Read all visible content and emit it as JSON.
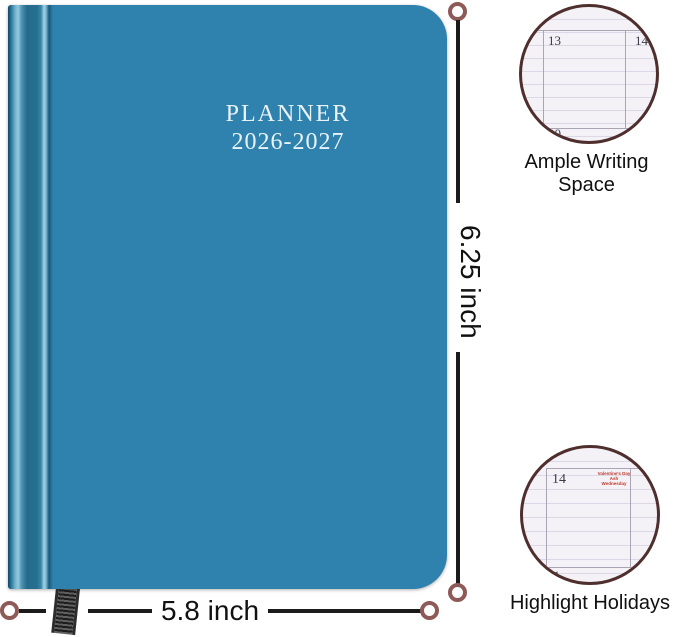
{
  "planner": {
    "title_line1": "PLANNER",
    "title_line2": "2026-2027",
    "cover_color": "#2e82ad"
  },
  "dimensions": {
    "height_label": "6.25 inch",
    "width_label": "5.8 inch"
  },
  "callouts": {
    "writing_space": {
      "label": "Ample Writing Space",
      "day_top_left": "13",
      "day_top_right": "14",
      "day_bottom_left": "20"
    },
    "holidays": {
      "label": "Highlight Holidays",
      "day_top_left": "14",
      "day_bottom_left": "21",
      "holiday_line1": "Valentine's Day",
      "holiday_line2": "Ash Wednesday"
    }
  },
  "colors": {
    "cover": "#2e82ad",
    "spine_highlight": "#9ed2e4",
    "ring": "#8d5a57",
    "dimension_line": "#1b1b1b",
    "circle_border": "#4f2f2d",
    "paper": "#f4f2f7",
    "holiday_text": "#c0392b",
    "title_text": "#e9f3f7"
  }
}
